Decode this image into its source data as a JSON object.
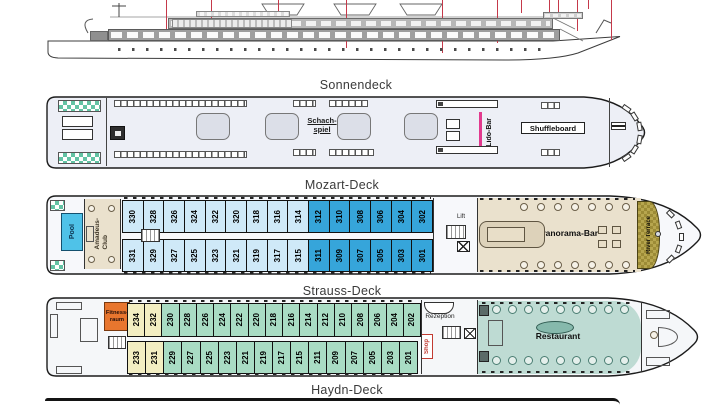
{
  "profile": {
    "leader_lines": [
      {
        "x": 166,
        "len": 31
      },
      {
        "x": 211,
        "len": 31
      },
      {
        "x": 278,
        "len": 13
      },
      {
        "x": 346,
        "len": 48
      },
      {
        "x": 442,
        "len": 53
      },
      {
        "x": 497,
        "len": 43
      },
      {
        "x": 521,
        "len": 13
      },
      {
        "x": 549,
        "len": 27
      },
      {
        "x": 558,
        "len": 13
      },
      {
        "x": 577,
        "len": 31
      },
      {
        "x": 588,
        "len": 9
      },
      {
        "x": 611,
        "len": 40
      }
    ]
  },
  "decks": {
    "sonnendeck": {
      "label": "Sonnendeck",
      "chess": "Schach-\nspiel",
      "lido_bar": "Lido-Bar",
      "shuffleboard": "Shuffleboard"
    },
    "mozart": {
      "label": "Mozart-Deck",
      "pool": "Pool",
      "amadeus_club": "Amadeus-\nClub",
      "lift": "Lift",
      "bar": "Bar",
      "panorama_bar": "Panorama-Bar",
      "river_terrace": "River Terrace",
      "cabins_top": [
        {
          "n": "330",
          "c": "b1"
        },
        {
          "n": "328",
          "c": "b1"
        },
        {
          "n": "326",
          "c": "b1"
        },
        {
          "n": "324",
          "c": "b1"
        },
        {
          "n": "322",
          "c": "b1"
        },
        {
          "n": "320",
          "c": "b1"
        },
        {
          "n": "318",
          "c": "b1"
        },
        {
          "n": "316",
          "c": "b1"
        },
        {
          "n": "314",
          "c": "b1"
        },
        {
          "n": "312",
          "c": "b2"
        },
        {
          "n": "310",
          "c": "b2"
        },
        {
          "n": "308",
          "c": "b2"
        },
        {
          "n": "306",
          "c": "b2"
        },
        {
          "n": "304",
          "c": "b2"
        },
        {
          "n": "302",
          "c": "b2"
        }
      ],
      "cabins_bottom": [
        {
          "n": "331",
          "c": "b1"
        },
        {
          "n": "329",
          "c": "b1"
        },
        {
          "n": "327",
          "c": "b1"
        },
        {
          "n": "325",
          "c": "b1"
        },
        {
          "n": "323",
          "c": "b1"
        },
        {
          "n": "321",
          "c": "b1"
        },
        {
          "n": "319",
          "c": "b1"
        },
        {
          "n": "317",
          "c": "b1"
        },
        {
          "n": "315",
          "c": "b1"
        },
        {
          "n": "311",
          "c": "b2"
        },
        {
          "n": "309",
          "c": "b2"
        },
        {
          "n": "307",
          "c": "b2"
        },
        {
          "n": "305",
          "c": "b2"
        },
        {
          "n": "303",
          "c": "b2"
        },
        {
          "n": "301",
          "c": "b2"
        }
      ]
    },
    "strauss": {
      "label": "Strauss-Deck",
      "fitness": "Fitness-\nraum",
      "rezeption": "Rezeption",
      "shop": "Shop",
      "restaurant": "Restaurant",
      "cabins_top": [
        {
          "n": "234",
          "c": "y"
        },
        {
          "n": "232",
          "c": "y"
        },
        {
          "n": "230",
          "c": "g"
        },
        {
          "n": "228",
          "c": "g"
        },
        {
          "n": "226",
          "c": "g"
        },
        {
          "n": "224",
          "c": "g"
        },
        {
          "n": "222",
          "c": "g"
        },
        {
          "n": "220",
          "c": "g"
        },
        {
          "n": "218",
          "c": "g"
        },
        {
          "n": "216",
          "c": "g"
        },
        {
          "n": "214",
          "c": "g"
        },
        {
          "n": "212",
          "c": "g"
        },
        {
          "n": "210",
          "c": "g"
        },
        {
          "n": "208",
          "c": "g"
        },
        {
          "n": "206",
          "c": "g"
        },
        {
          "n": "204",
          "c": "g"
        },
        {
          "n": "202",
          "c": "g"
        }
      ],
      "cabins_bottom": [
        {
          "n": "233",
          "c": "y"
        },
        {
          "n": "231",
          "c": "y"
        },
        {
          "n": "229",
          "c": "g"
        },
        {
          "n": "227",
          "c": "g"
        },
        {
          "n": "225",
          "c": "g"
        },
        {
          "n": "223",
          "c": "g"
        },
        {
          "n": "221",
          "c": "g"
        },
        {
          "n": "219",
          "c": "g"
        },
        {
          "n": "217",
          "c": "g"
        },
        {
          "n": "215",
          "c": "g"
        },
        {
          "n": "211",
          "c": "g"
        },
        {
          "n": "209",
          "c": "g"
        },
        {
          "n": "207",
          "c": "g"
        },
        {
          "n": "205",
          "c": "g"
        },
        {
          "n": "203",
          "c": "g"
        },
        {
          "n": "201",
          "c": "g"
        }
      ]
    },
    "haydn": {
      "label": "Haydn-Deck"
    }
  },
  "colors": {
    "cabin_light_blue": "#cfe9f8",
    "cabin_blue": "#36a5da",
    "cabin_green": "#a9dcc4",
    "cabin_yellow": "#f3eec2",
    "pool": "#4fc2e8",
    "beige": "#eae1cd",
    "restaurant_teal": "#bedbd3",
    "terrace_gold": "#b2a14b",
    "fitness_orange": "#e8762e",
    "accent_red": "#c23b32",
    "accent_pink": "#e23a8e",
    "leader_line_red": "#c5394a",
    "checker_green": "#63c3a4"
  }
}
